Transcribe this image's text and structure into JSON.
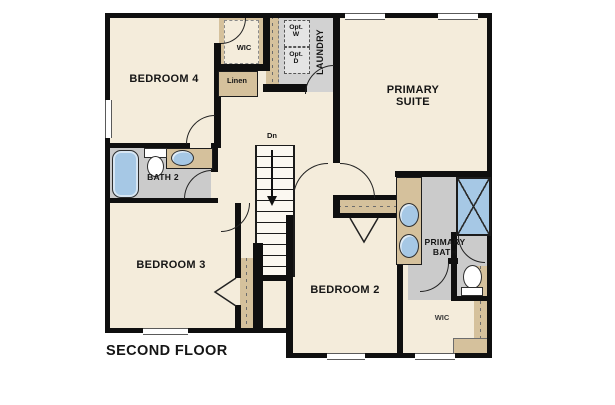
{
  "floor_plan": {
    "title": "SECOND FLOOR",
    "labels": {
      "bedroom4": "BEDROOM 4",
      "wic_upper": "WIC",
      "linen": "Linen",
      "opt_washer_1": "Opt.",
      "opt_washer_2": "W",
      "opt_dryer_1": "Opt.",
      "opt_dryer_2": "D",
      "laundry": "LAUNDRY",
      "primary_suite": "PRIMARY SUITE",
      "bath2": "BATH 2",
      "stairs_dn": "Dn",
      "bedroom3": "BEDROOM 3",
      "bedroom2": "BEDROOM 2",
      "primary_bath": "PRIMARY BATH",
      "wic_lower": "WIC"
    },
    "fixtures": [
      "bathtub",
      "toilet",
      "sink",
      "double-vanity-sinks",
      "shower",
      "staircase-down",
      "washer-optional",
      "dryer-optional"
    ],
    "colors": {
      "background": "#ffffff",
      "floor": "#f4ecdb",
      "tile": "#cbcbcb",
      "casework": "#d5c19c",
      "wall": "#0f0f0f",
      "fixture_blue": "#a6c8e5"
    }
  }
}
